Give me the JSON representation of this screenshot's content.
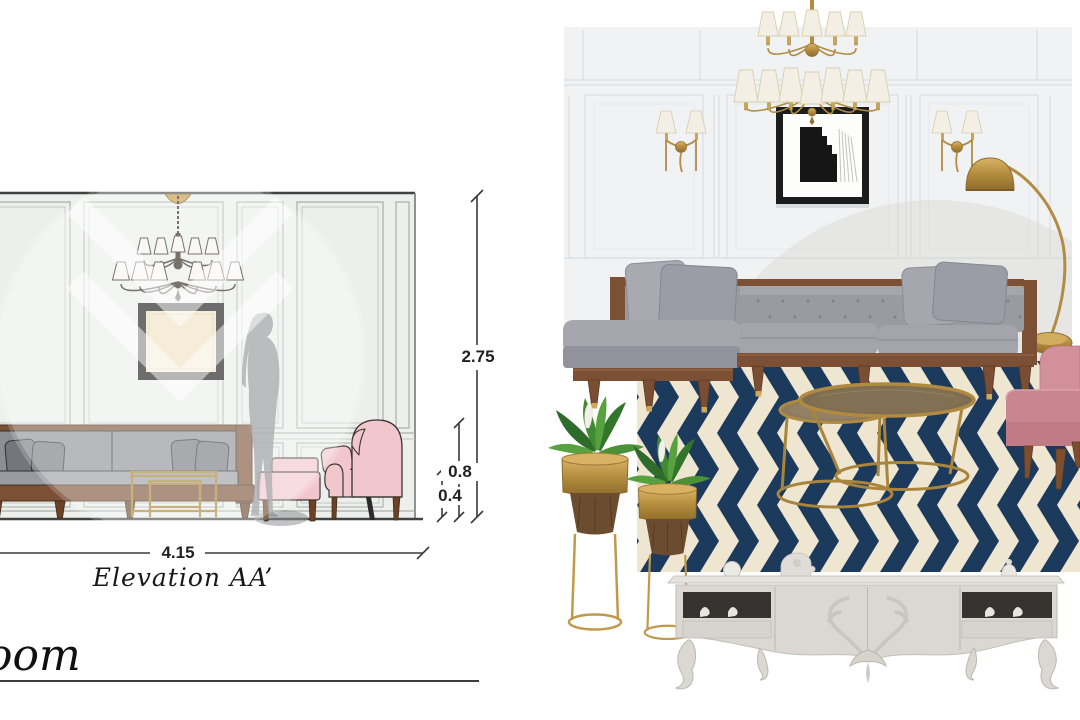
{
  "elevation": {
    "caption": "Elevation AA’",
    "dimensions": {
      "height_total": "2.75",
      "height_sofa": "0.8",
      "height_table": "0.4",
      "width_total": "4.15"
    },
    "objects": [
      "wall-paneling",
      "ceiling-medallion",
      "chandelier",
      "framed-artwork",
      "sofa",
      "nesting-coffee-tables",
      "pink-ottoman",
      "pink-wingback-armchair",
      "human-silhouette"
    ]
  },
  "moodboard": {
    "objects": [
      "paneled-wall",
      "brass-chandelier",
      "wall-sconce-left",
      "wall-sconce-right",
      "framed-artwork",
      "arc-floor-lamp",
      "sectional-sofa",
      "chevron-rug",
      "nesting-coffee-tables",
      "blush-accent-chair",
      "brass-planter-large",
      "brass-planter-small",
      "ornate-tv-console"
    ]
  },
  "footer": {
    "partial_title": "oom"
  },
  "colors": {
    "navy": "#1c3a5c",
    "cream": "#eee6d0",
    "brass": "#b28c42",
    "blush": "#f2c6cd",
    "rose": "#ca8690",
    "sofa-gray": "#9a9aa3",
    "wood": "#7b5034",
    "wall-left": "#edefec",
    "wall-right": "#f0f2f3",
    "ink": "#222222"
  }
}
